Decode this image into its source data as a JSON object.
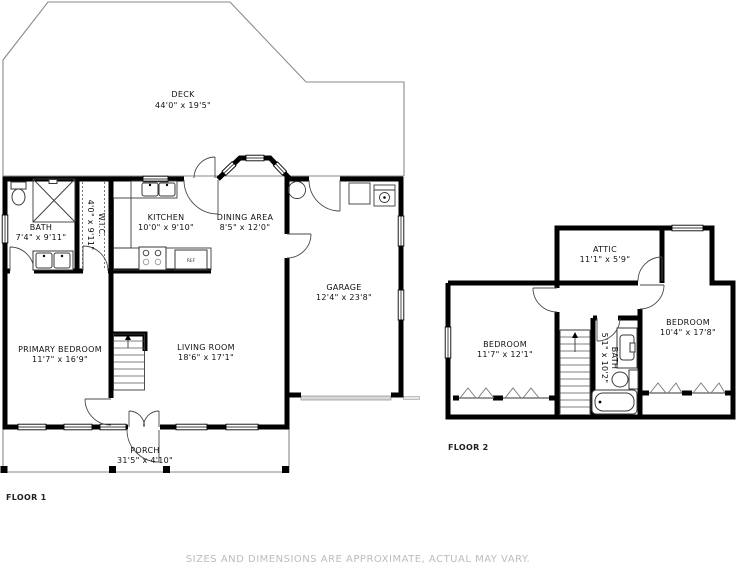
{
  "footer": {
    "disclaimer": "SIZES AND DIMENSIONS ARE APPROXIMATE, ACTUAL MAY VARY."
  },
  "floor1": {
    "label": "FLOOR 1",
    "rooms": {
      "deck": {
        "name": "DECK",
        "dims": "44'0\" x 19'5\""
      },
      "bath": {
        "name": "BATH",
        "dims": "7'4\" x 9'11\""
      },
      "wic": {
        "name": "W.I.C.",
        "dims": "4'0\" x 9'11\""
      },
      "kitchen": {
        "name": "KITCHEN",
        "dims": "10'0\" x 9'10\""
      },
      "dining": {
        "name": "DINING AREA",
        "dims": "8'5\" x 12'0\""
      },
      "garage": {
        "name": "GARAGE",
        "dims": "12'4\" x 23'8\""
      },
      "primary_bedroom": {
        "name": "PRIMARY BEDROOM",
        "dims": "11'7\" x 16'9\""
      },
      "living": {
        "name": "LIVING ROOM",
        "dims": "18'6\" x 17'1\""
      },
      "porch": {
        "name": "PORCH",
        "dims": "31'5\" x 4'10\""
      }
    },
    "appliances": {
      "fridge": "REF"
    }
  },
  "floor2": {
    "label": "FLOOR 2",
    "rooms": {
      "attic": {
        "name": "ATTIC",
        "dims": "11'1\" x 5'9\""
      },
      "bedroom_left": {
        "name": "BEDROOM",
        "dims": "11'7\" x 12'1\""
      },
      "bath": {
        "name": "BATH",
        "dims": "5'1\" x 10'2\""
      },
      "bedroom_right": {
        "name": "BEDROOM",
        "dims": "10'4\" x 17'8\""
      }
    }
  }
}
